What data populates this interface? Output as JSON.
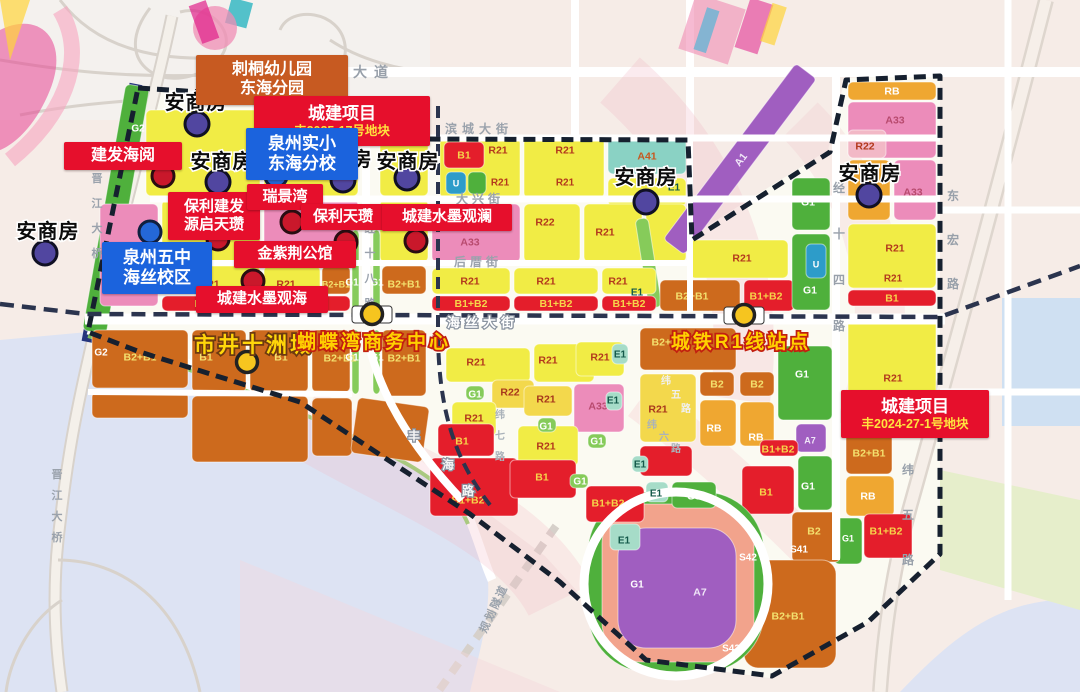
{
  "palette": {
    "Y": "#f1ec45",
    "A": "#f3d84c",
    "G": "#4fb03c",
    "LG": "#86cb5a",
    "E": "#a6dcc8",
    "T": "#8ad2c4",
    "O": "#cd6a1d",
    "R": "#e41e2b",
    "P": "#ec8cba",
    "RO": "#f2b8c6",
    "GO": "#efa731",
    "PU": "#a05ec0",
    "U": "#2d9cc9",
    "SA": "#f2a38c",
    "water": "#dde3f3",
    "outside": "#f6ece7",
    "base": "#fbfaf2",
    "boundary": "#16202f",
    "rail": "#2b344e",
    "callout_red": "#e60f2c",
    "callout_blue": "#1b63dd",
    "callout_orange": "#c75a21",
    "marker_purple": "#5146a0",
    "marker_red": "#c9182b",
    "marker_blue": "#2468d8",
    "station": "#f6c51f"
  },
  "code_colors": {
    "Y": "#b3391d",
    "A": "#a8381c",
    "G": "#ffffff",
    "LG": "#2f6b1f",
    "E": "#14594a",
    "T": "#c65820",
    "O": "#f3e06e",
    "R": "#f6d44a",
    "P": "#b84a6e",
    "RO": "#b3391d",
    "GO": "#ffffff",
    "PU": "#f0e6f8",
    "U": "#ffffff",
    "SA": "#ffffff"
  },
  "parcels": [
    [
      "",
      104,
      84,
      24,
      250,
      "G",
      0,
      0,
      10
    ],
    [
      "",
      146,
      110,
      114,
      86,
      "Y"
    ],
    [
      "",
      264,
      110,
      94,
      86,
      "Y"
    ],
    [
      "",
      380,
      110,
      48,
      86,
      "Y"
    ],
    [
      "G1",
      306,
      112,
      34,
      18,
      "G"
    ],
    [
      "",
      100,
      204,
      58,
      102,
      "P"
    ],
    [
      "",
      162,
      200,
      98,
      62,
      "Y"
    ],
    [
      "",
      264,
      200,
      94,
      62,
      "P"
    ],
    [
      "",
      380,
      200,
      48,
      62,
      "Y"
    ],
    [
      "R21",
      162,
      266,
      98,
      28,
      "Y",
      210,
      284
    ],
    [
      "R21",
      264,
      266,
      56,
      28,
      "Y",
      286,
      284
    ],
    [
      "B2+B1",
      322,
      266,
      28,
      28,
      "O",
      336,
      284
    ],
    [
      "B2+B1",
      382,
      266,
      44,
      28,
      "O",
      404,
      284
    ],
    [
      "B1+B2",
      162,
      296,
      98,
      15,
      "R"
    ],
    [
      "",
      264,
      296,
      86,
      15,
      "R"
    ],
    [
      "",
      352,
      230,
      7,
      80,
      "LG"
    ],
    [
      "",
      373,
      230,
      7,
      80,
      "LG"
    ],
    [
      "",
      352,
      330,
      7,
      64,
      "LG"
    ],
    [
      "",
      373,
      330,
      7,
      64,
      "LG"
    ],
    [
      "B1",
      192,
      330,
      54,
      62,
      "O",
      206,
      357
    ],
    [
      "B1",
      250,
      330,
      58,
      62,
      "O",
      281,
      357
    ],
    [
      "B2+B1",
      312,
      330,
      38,
      62,
      "O",
      340,
      358
    ],
    [
      "B2+B1",
      382,
      330,
      44,
      66,
      "O",
      404,
      358
    ],
    [
      "B2+B1",
      92,
      330,
      96,
      58,
      "O",
      140,
      357
    ],
    [
      "",
      192,
      396,
      116,
      66,
      "O"
    ],
    [
      "",
      312,
      398,
      40,
      58,
      "O"
    ],
    [
      "",
      92,
      392,
      96,
      26,
      "O"
    ],
    [
      "",
      354,
      402,
      72,
      56,
      "O",
      0,
      0,
      8
    ],
    [
      "R21",
      440,
      138,
      80,
      60,
      "Y",
      498,
      150
    ],
    [
      "R21",
      524,
      138,
      80,
      60,
      "Y",
      565,
      150
    ],
    [
      "B1",
      444,
      142,
      40,
      26,
      "R"
    ],
    [
      "U",
      446,
      172,
      20,
      22,
      "U"
    ],
    [
      "",
      468,
      172,
      18,
      22,
      "G"
    ],
    [
      "A41",
      608,
      138,
      78,
      36,
      "T"
    ],
    [
      "",
      608,
      178,
      78,
      28,
      "Y"
    ],
    [
      "A33",
      432,
      204,
      88,
      58,
      "P",
      470,
      242
    ],
    [
      "R22",
      524,
      204,
      56,
      58,
      "Y",
      545,
      222
    ],
    [
      "R21",
      584,
      204,
      58,
      58,
      "Y",
      605,
      232
    ],
    [
      "",
      646,
      204,
      40,
      58,
      "Y"
    ],
    [
      "",
      642,
      218,
      13,
      90,
      "LG",
      0,
      0,
      -9
    ],
    [
      "R21",
      432,
      268,
      78,
      26,
      "Y",
      470,
      281
    ],
    [
      "R21",
      514,
      268,
      84,
      26,
      "Y",
      546,
      281
    ],
    [
      "R21",
      602,
      268,
      54,
      26,
      "Y",
      618,
      281
    ],
    [
      "B1+B2",
      432,
      296,
      78,
      15,
      "R"
    ],
    [
      "B1+B2",
      514,
      296,
      84,
      15,
      "R"
    ],
    [
      "B1+B2",
      602,
      296,
      54,
      15,
      "R"
    ],
    [
      "B2+B1",
      660,
      280,
      80,
      31,
      "O",
      692,
      296
    ],
    [
      "B1+B2",
      744,
      280,
      50,
      31,
      "R",
      766,
      296
    ],
    [
      "A1",
      630,
      146,
      220,
      26,
      "PU",
      740,
      160,
      -53,
      4
    ],
    [
      "G1",
      792,
      178,
      38,
      52,
      "G",
      808,
      202
    ],
    [
      "G1",
      792,
      234,
      38,
      76,
      "G",
      810,
      290
    ],
    [
      "R21",
      690,
      240,
      98,
      38,
      "Y",
      742,
      258
    ],
    [
      "U",
      806,
      244,
      20,
      34,
      "U",
      816,
      264
    ],
    [
      "RB",
      848,
      82,
      88,
      18,
      "GO"
    ],
    [
      "A33",
      848,
      102,
      88,
      56,
      "P",
      895,
      120
    ],
    [
      "R22",
      848,
      130,
      38,
      28,
      "RO",
      865,
      146
    ],
    [
      "",
      848,
      160,
      42,
      60,
      "GO"
    ],
    [
      "A33",
      894,
      160,
      42,
      60,
      "P",
      913,
      192
    ],
    [
      "R21",
      848,
      224,
      88,
      64,
      "Y",
      895,
      248
    ],
    [
      "B1",
      848,
      290,
      88,
      16,
      "R"
    ],
    [
      "R21",
      848,
      314,
      88,
      112,
      "Y",
      893,
      378
    ],
    [
      "B2+B1",
      846,
      430,
      46,
      44,
      "O",
      869,
      453
    ],
    [
      "RB",
      846,
      476,
      48,
      40,
      "GO",
      868,
      496
    ],
    [
      "G1",
      834,
      518,
      28,
      46,
      "G",
      848,
      538
    ],
    [
      "B1+B2",
      864,
      514,
      48,
      44,
      "R",
      886,
      531
    ],
    [
      "B2+B1",
      640,
      328,
      96,
      42,
      "O",
      668,
      342
    ],
    [
      "R21",
      640,
      374,
      56,
      68,
      "A",
      658,
      409
    ],
    [
      "B2",
      700,
      372,
      34,
      24,
      "O"
    ],
    [
      "B2",
      740,
      372,
      34,
      24,
      "O"
    ],
    [
      "RB",
      700,
      400,
      36,
      46,
      "GO",
      714,
      428
    ],
    [
      "RB",
      740,
      402,
      34,
      44,
      "GO",
      756,
      437
    ],
    [
      "G1",
      778,
      346,
      54,
      74,
      "G",
      802,
      374
    ],
    [
      "A7",
      796,
      424,
      30,
      28,
      "PU",
      810,
      440
    ],
    [
      "B1+B2",
      760,
      440,
      38,
      16,
      "R",
      778,
      449
    ],
    [
      "B1",
      742,
      466,
      52,
      48,
      "R",
      766,
      492
    ],
    [
      "G1",
      798,
      456,
      34,
      54,
      "G",
      808,
      486
    ],
    [
      "B2",
      792,
      512,
      48,
      50,
      "O",
      814,
      531
    ],
    [
      "B2+B1",
      744,
      560,
      92,
      108,
      "O",
      788,
      616,
      0,
      14
    ],
    [
      "",
      588,
      492,
      176,
      180,
      "G",
      0,
      0,
      0,
      60
    ],
    [
      "A2",
      602,
      504,
      152,
      158,
      "SA",
      710,
      540,
      0,
      40
    ],
    [
      "A7",
      618,
      528,
      118,
      120,
      "PU",
      700,
      592,
      0,
      28
    ],
    [
      "",
      610,
      524,
      30,
      26,
      "E"
    ],
    [
      "G3",
      672,
      482,
      44,
      26,
      "G",
      694,
      496
    ],
    [
      "",
      646,
      482,
      22,
      20,
      "E"
    ],
    [
      "B1+B2",
      586,
      486,
      58,
      36,
      "R",
      608,
      503
    ],
    [
      "",
      640,
      446,
      52,
      30,
      "R"
    ],
    [
      "R21",
      446,
      348,
      84,
      34,
      "Y",
      476,
      362
    ],
    [
      "R21",
      534,
      344,
      60,
      38,
      "Y",
      548,
      360
    ],
    [
      "R21",
      576,
      342,
      48,
      34,
      "Y",
      600,
      357
    ],
    [
      "R22",
      492,
      380,
      42,
      28,
      "A",
      510,
      392
    ],
    [
      "R21",
      524,
      386,
      48,
      30,
      "A",
      546,
      399
    ],
    [
      "A33",
      574,
      384,
      50,
      48,
      "P",
      598,
      406
    ],
    [
      "R21",
      452,
      402,
      44,
      34,
      "Y",
      474,
      418
    ],
    [
      "B1",
      438,
      424,
      56,
      32,
      "R",
      462,
      441
    ],
    [
      "B1+B2",
      430,
      458,
      88,
      58,
      "R",
      468,
      500
    ],
    [
      "R21",
      518,
      426,
      60,
      40,
      "Y",
      546,
      446
    ],
    [
      "B1",
      510,
      460,
      66,
      38,
      "R",
      542,
      477
    ],
    [
      "",
      466,
      386,
      18,
      14,
      "LG"
    ],
    [
      "",
      538,
      418,
      18,
      14,
      "LG"
    ],
    [
      "",
      588,
      434,
      18,
      14,
      "LG"
    ],
    [
      "",
      570,
      474,
      18,
      14,
      "LG"
    ],
    [
      "",
      612,
      344,
      16,
      20,
      "E"
    ],
    [
      "",
      606,
      392,
      16,
      18,
      "E"
    ],
    [
      "",
      632,
      456,
      16,
      16,
      "E"
    ]
  ],
  "zone_labels": [
    [
      "G2",
      138,
      128,
      "#ffffff"
    ],
    [
      "G2",
      101,
      352,
      "#ffffff"
    ],
    [
      "G1",
      352,
      282,
      "#ffffff"
    ],
    [
      "G1",
      377,
      282,
      "#ffffff"
    ],
    [
      "G1",
      352,
      357,
      "#ffffff"
    ],
    [
      "G1",
      377,
      357,
      "#ffffff"
    ],
    [
      "E1",
      637,
      292,
      "#14594a"
    ],
    [
      "E1",
      620,
      354,
      "#14594a"
    ],
    [
      "E1",
      613,
      400,
      "#14594a"
    ],
    [
      "E1",
      640,
      464,
      "#14594a"
    ],
    [
      "E1",
      656,
      493,
      "#14594a"
    ],
    [
      "E1",
      624,
      540,
      "#14594a"
    ],
    [
      "E1",
      674,
      187,
      "#14594a"
    ],
    [
      "G1",
      475,
      394,
      "#ffffff"
    ],
    [
      "G1",
      546,
      426,
      "#ffffff"
    ],
    [
      "G1",
      597,
      441,
      "#ffffff"
    ],
    [
      "G1",
      580,
      481,
      "#ffffff"
    ],
    [
      "G1",
      637,
      584,
      "#ffffff"
    ],
    [
      "R21",
      893,
      278,
      "#b3391d"
    ],
    [
      "R21",
      500,
      182,
      "#b3391d"
    ],
    [
      "R21",
      565,
      182,
      "#b3391d"
    ],
    [
      "S42",
      748,
      557,
      "#ffffff"
    ],
    [
      "S41",
      799,
      549,
      "#ffffff"
    ],
    [
      "S42",
      731,
      648,
      "#ffffff"
    ]
  ],
  "road_labels": [
    {
      "t": "东海大道",
      "x": 353,
      "y": 77,
      "m": "h",
      "s": 14,
      "ls": 7,
      "c": "#98a0aa"
    },
    {
      "t": "滨城大街",
      "x": 479,
      "y": 133,
      "m": "h",
      "s": 12,
      "ls": 5,
      "c": "#9aa2ac"
    },
    {
      "t": "大兴街",
      "x": 480,
      "y": 203,
      "m": "h",
      "s": 12,
      "ls": 4,
      "c": "#9aa2ac"
    },
    {
      "t": "后厝街",
      "x": 478,
      "y": 266,
      "m": "h",
      "s": 12,
      "ls": 4,
      "c": "#9aa2ac"
    },
    {
      "t": "海丝大街",
      "x": 483,
      "y": 327,
      "m": "h",
      "s": 13,
      "ls": 5,
      "c": "#ffffff",
      "halo": "#8a93a0"
    },
    {
      "t": "经十八路",
      "x": 370,
      "y": 232,
      "m": "v",
      "gap": 25,
      "s": 11,
      "c": "#9aa2ac"
    },
    {
      "t": "经十四路",
      "x": 839,
      "y": 192,
      "m": "v",
      "gap": 46,
      "s": 12,
      "c": "#98a0aa"
    },
    {
      "t": "东宏路",
      "x": 953,
      "y": 200,
      "m": "v",
      "gap": 44,
      "s": 12,
      "c": "#98a0aa"
    },
    {
      "t": "纬五路",
      "x": 908,
      "y": 474,
      "m": "v",
      "gap": 45,
      "s": 12,
      "c": "#98a0aa"
    },
    {
      "t": "晋江大桥",
      "x": 97,
      "y": 182,
      "m": "v",
      "gap": 25,
      "s": 11,
      "c": "#9aa2ac"
    },
    {
      "t": "晋江大桥",
      "x": 57,
      "y": 478,
      "m": "v",
      "gap": 21,
      "s": 11,
      "c": "#9aa2ac"
    },
    {
      "t": "规划隧道",
      "x": 497,
      "y": 610,
      "m": "rot",
      "deg": -65,
      "s": 11,
      "ls": 2,
      "c": "#9aa2ac"
    },
    {
      "t": "丰海路",
      "m": "chars",
      "s": 12,
      "c": "#f5f5f5",
      "halo": "#8a93a0",
      "chars": [
        [
          414,
          440
        ],
        [
          448,
          469
        ],
        [
          468,
          495
        ]
      ]
    },
    {
      "t": "纬七路",
      "x": 500,
      "y": 418,
      "m": "v",
      "gap": 21,
      "s": 10,
      "c": "#aab2ba"
    },
    {
      "t": "纬六路",
      "m": "chars",
      "s": 10,
      "c": "#aab2ba",
      "chars": [
        [
          652,
          428
        ],
        [
          664,
          440
        ],
        [
          676,
          452
        ]
      ]
    },
    {
      "t": "纬五路",
      "m": "chars",
      "s": 10,
      "c": "#f0f0f0",
      "chars": [
        [
          666,
          384
        ],
        [
          676,
          398
        ],
        [
          686,
          412
        ]
      ]
    }
  ],
  "name_labels": [
    {
      "text": "安商房",
      "x": 196,
      "y": 102
    },
    {
      "text": "安商房",
      "x": 48,
      "y": 231
    },
    {
      "text": "安商房",
      "x": 222,
      "y": 161
    },
    {
      "text": "安商房",
      "x": 341,
      "y": 159
    },
    {
      "text": "安商房",
      "x": 408,
      "y": 161
    },
    {
      "text": "安商房",
      "x": 646,
      "y": 177
    },
    {
      "text": "安商房",
      "x": 870,
      "y": 173
    }
  ],
  "big_labels": [
    {
      "text": "市井十洲城",
      "x": 254,
      "y": 345,
      "color": "#ffd60a",
      "stroke": "#6e3a10",
      "size": 21
    },
    {
      "text": "蝴蝶湾商务中心",
      "x": 374,
      "y": 341,
      "color": "#ffd000",
      "stroke": "#c21f10",
      "size": 19
    },
    {
      "text": "城铁R1线站点",
      "x": 741,
      "y": 341,
      "color": "#ffd000",
      "stroke": "#c21f10",
      "size": 19
    }
  ],
  "callouts": [
    {
      "id": "citong-kindergarten",
      "type": "orange",
      "lines": [
        "刺桐幼儿园",
        "东海分园"
      ],
      "x": 272,
      "y": 80,
      "w": 152,
      "h": 50,
      "fs": 16
    },
    {
      "id": "chengjian-2025",
      "type": "red",
      "lines": [
        "城建项目"
      ],
      "sub": "丰2025-17号地块",
      "x": 342,
      "y": 121,
      "w": 176,
      "h": 50,
      "fs": 17
    },
    {
      "id": "jianfa-haiyue",
      "type": "red",
      "lines": [
        "建发海阅"
      ],
      "x": 123,
      "y": 156,
      "w": 118,
      "h": 28,
      "fs": 16
    },
    {
      "id": "quanzhou-shixiao",
      "type": "blue",
      "lines": [
        "泉州实小",
        "东海分校"
      ],
      "x": 302,
      "y": 154,
      "w": 112,
      "h": 52,
      "fs": 17
    },
    {
      "id": "baoli-jianfa-yuanqi",
      "type": "red",
      "lines": [
        "保利建发",
        "源启天瓒"
      ],
      "x": 214,
      "y": 216,
      "w": 92,
      "h": 48,
      "fs": 15
    },
    {
      "id": "ruijingwan",
      "type": "red",
      "lines": [
        "瑞景湾"
      ],
      "x": 285,
      "y": 197,
      "w": 76,
      "h": 26,
      "fs": 15
    },
    {
      "id": "baoli-tianzan",
      "type": "red",
      "lines": [
        "保利天瓒"
      ],
      "x": 343,
      "y": 217,
      "w": 84,
      "h": 26,
      "fs": 15
    },
    {
      "id": "shuimo-guanlan",
      "type": "red",
      "lines": [
        "城建水墨观澜"
      ],
      "x": 447,
      "y": 217,
      "w": 130,
      "h": 27,
      "fs": 15
    },
    {
      "id": "jinzijing",
      "type": "red",
      "lines": [
        "金紫荆公馆"
      ],
      "x": 295,
      "y": 254,
      "w": 122,
      "h": 27,
      "fs": 15
    },
    {
      "id": "quanzhou-wuzhong",
      "type": "blue",
      "lines": [
        "泉州五中",
        "海丝校区"
      ],
      "x": 157,
      "y": 268,
      "w": 110,
      "h": 52,
      "fs": 17
    },
    {
      "id": "shuimo-guanhai",
      "type": "red",
      "lines": [
        "城建水墨观海"
      ],
      "x": 262,
      "y": 299,
      "w": 132,
      "h": 27,
      "fs": 15
    },
    {
      "id": "chengjian-2024",
      "type": "red",
      "lines": [
        "城建项目"
      ],
      "sub": "丰2024-27-1号地块",
      "x": 915,
      "y": 414,
      "w": 148,
      "h": 48,
      "fs": 17
    }
  ],
  "markers": {
    "purple": [
      [
        197,
        124
      ],
      [
        45,
        253
      ],
      [
        218,
        182
      ],
      [
        343,
        180
      ],
      [
        407,
        178
      ],
      [
        646,
        202
      ],
      [
        869,
        195
      ]
    ],
    "red": [
      [
        163,
        176
      ],
      [
        218,
        239
      ],
      [
        292,
        222
      ],
      [
        346,
        242
      ],
      [
        416,
        241
      ],
      [
        253,
        281
      ]
    ],
    "blue": [
      [
        276,
        176
      ],
      [
        150,
        232
      ]
    ],
    "station": [
      [
        372,
        314
      ],
      [
        744,
        315
      ],
      [
        247,
        362
      ]
    ],
    "platforms": [
      [
        372,
        314
      ],
      [
        744,
        315
      ]
    ],
    "arrow": [
      [
        295,
        103
      ],
      [
        316,
        99
      ],
      [
        308,
        130
      ]
    ]
  }
}
